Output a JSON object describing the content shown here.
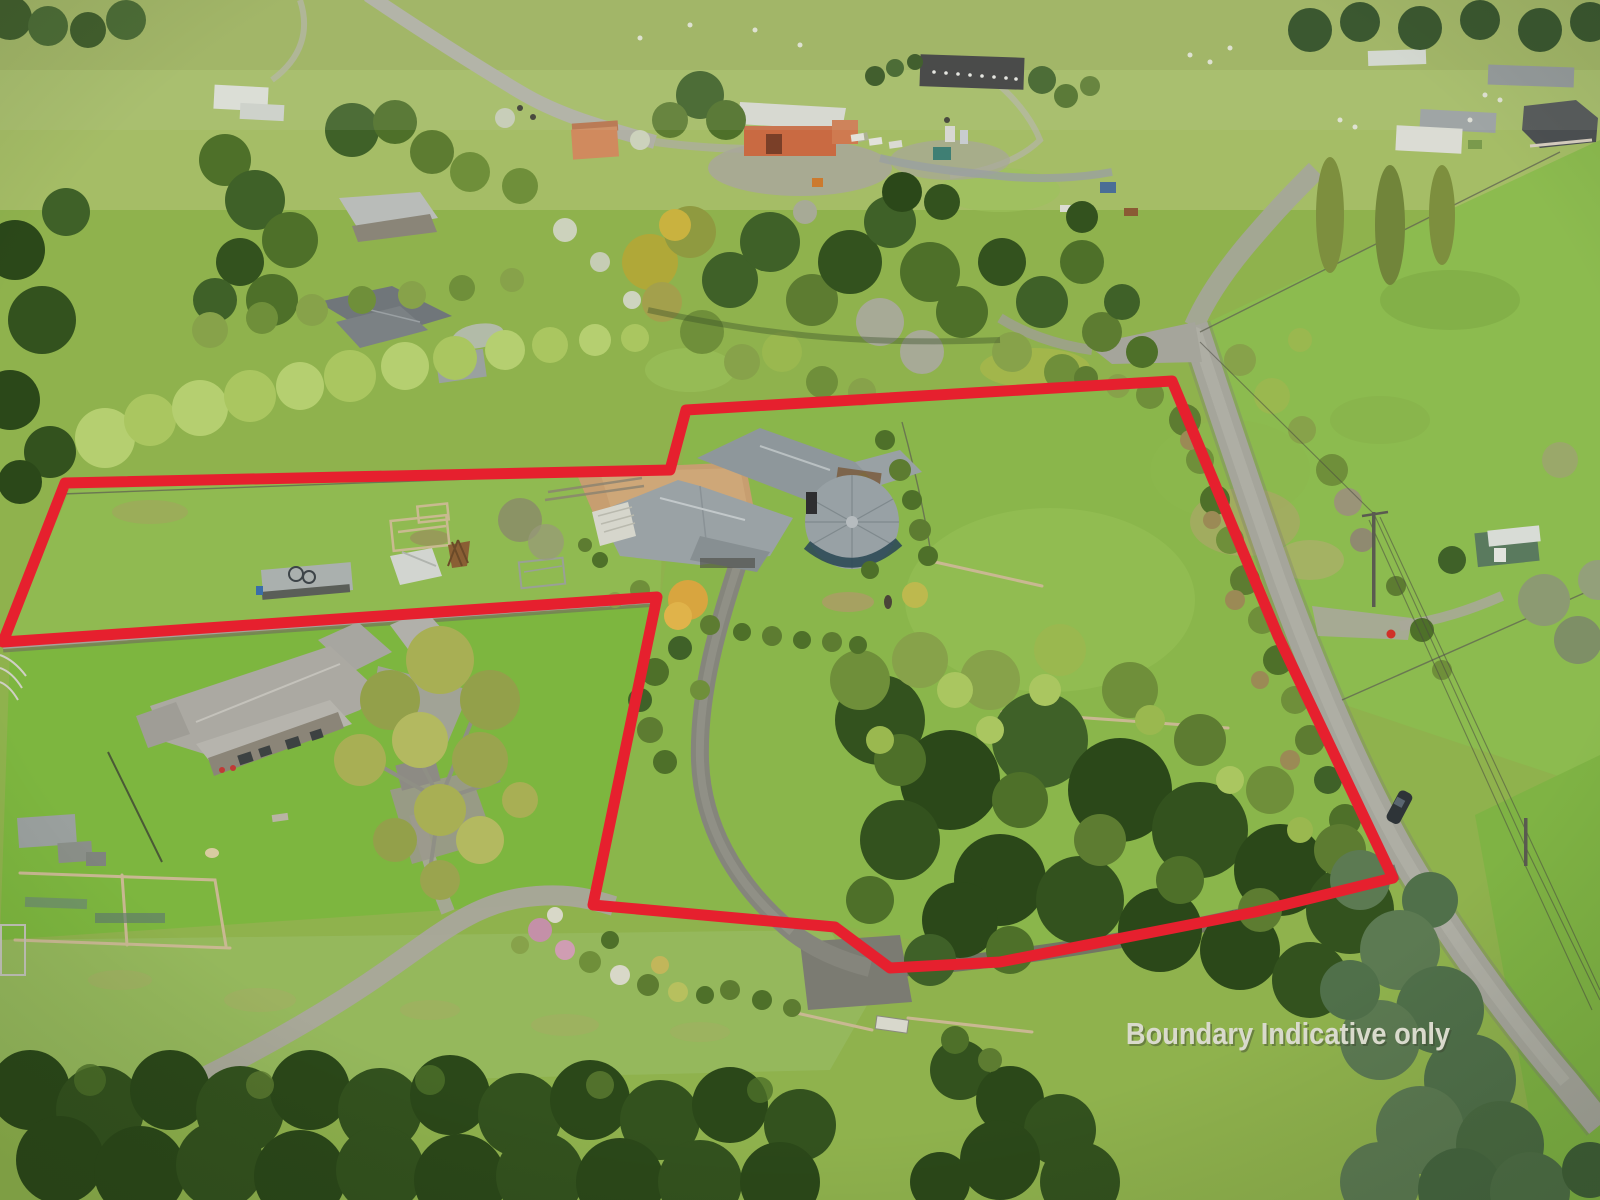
{
  "image": {
    "kind": "aerial-drone-photograph",
    "subject": "rural lifestyle property and paddocks outlined with a red indicative boundary",
    "width_px": 1600,
    "height_px": 1200
  },
  "overlay": {
    "disclaimer_label": "Boundary Indicative only",
    "boundary_color": "#e6202e",
    "boundary_points": "65,483 670,470 686,410 1172,381 1278,636 1393,878 1255,912 1000,962 890,968 835,927 593,905 657,597 3,642"
  },
  "palette": {
    "pasture": "#8fb24d",
    "bright_lawn": "#7db63f",
    "dark_trees": "#33521e",
    "spring_trees": "#b5cf70",
    "road": "#a5a59b",
    "roof_gray": "#9aa2a5",
    "barn_orange": "#c96a42",
    "boundary_red": "#e6202e",
    "label_text": "#d9dacc"
  }
}
